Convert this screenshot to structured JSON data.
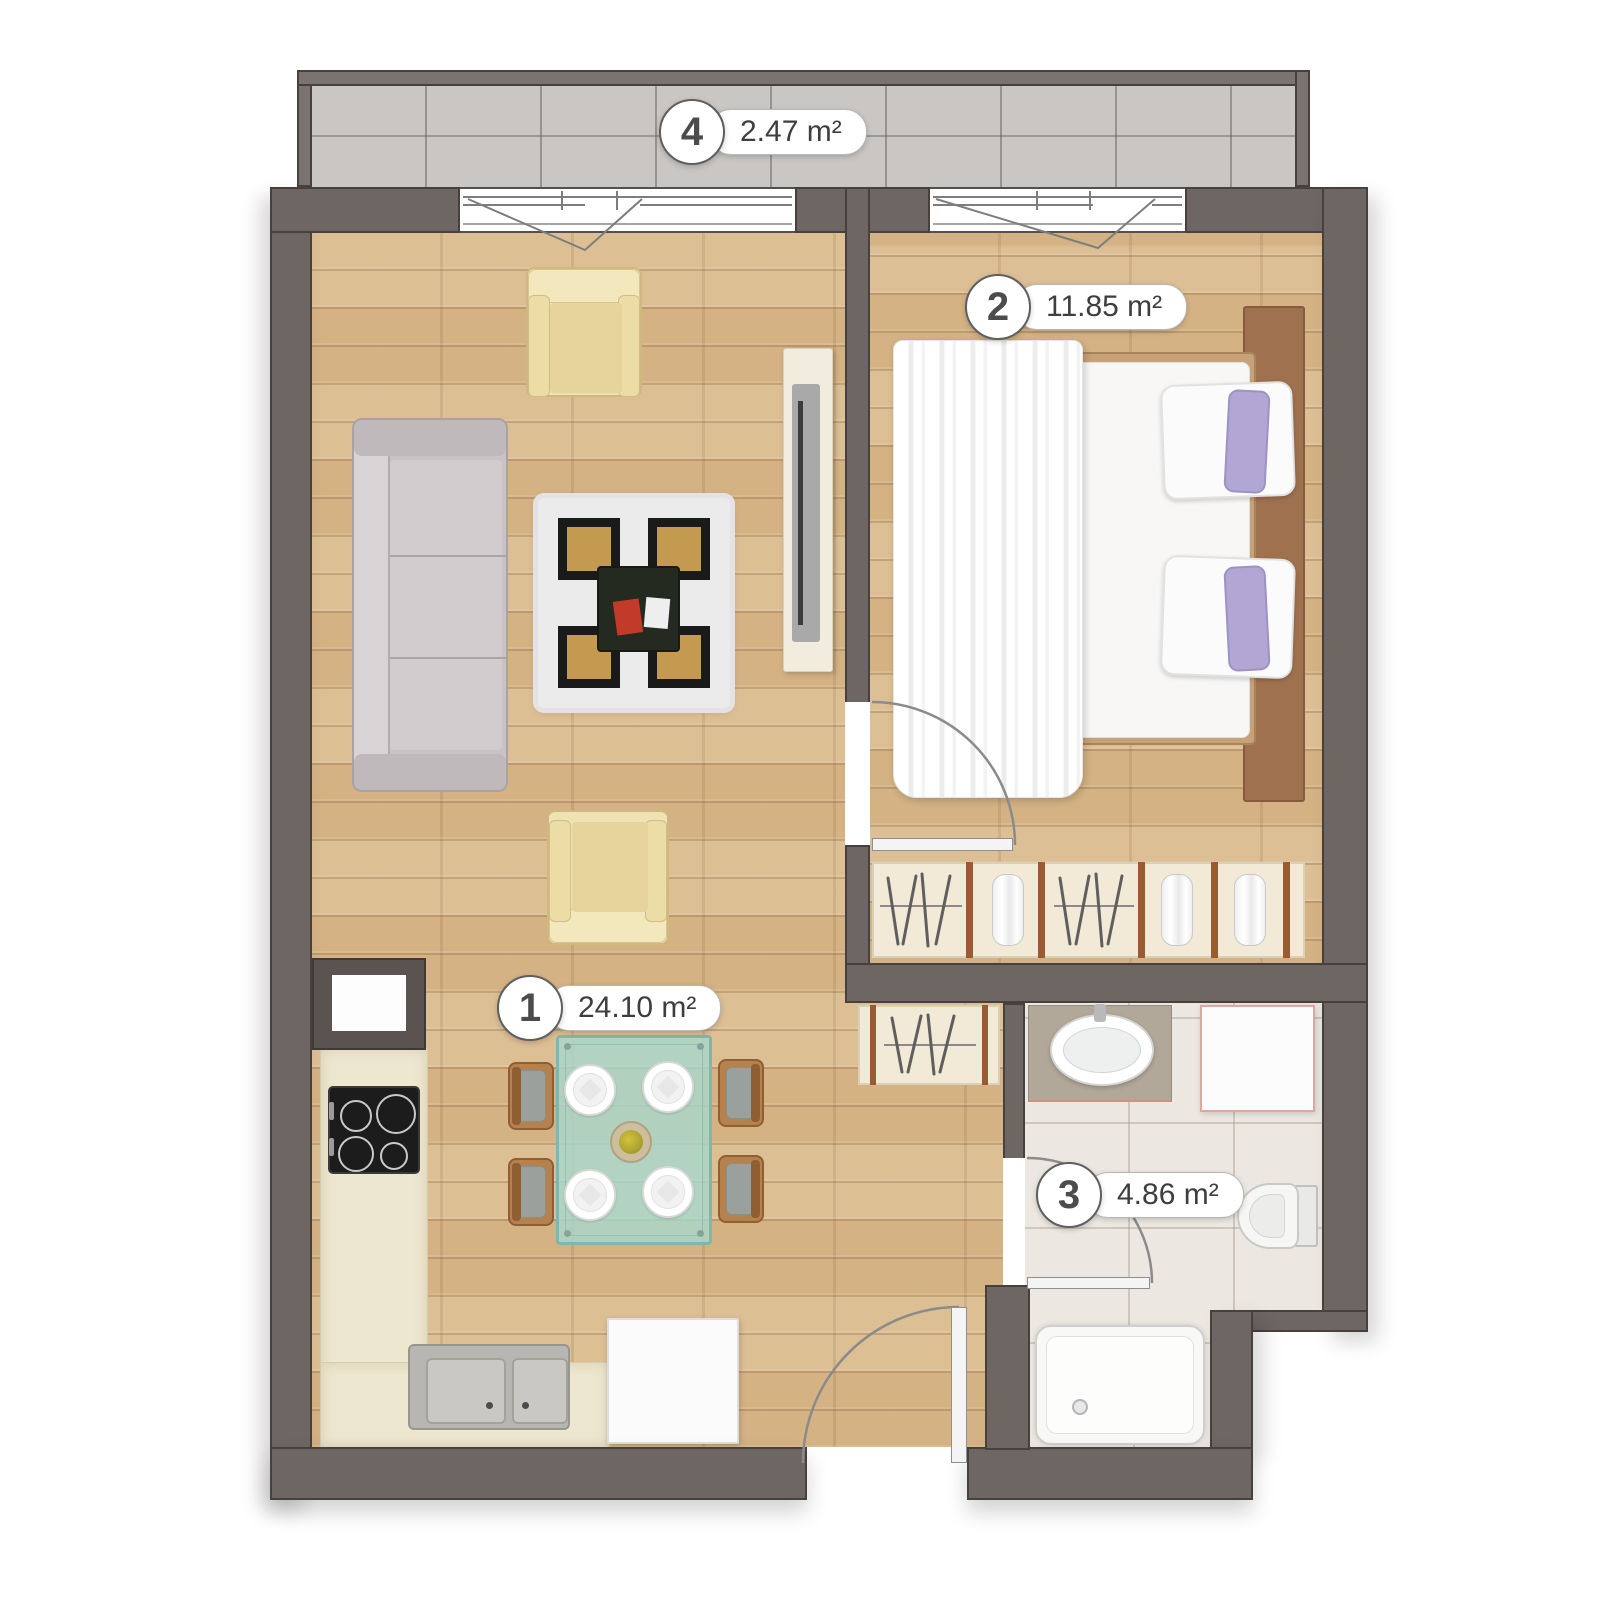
{
  "plan": {
    "rooms": [
      {
        "id": "living-kitchen",
        "number": "1",
        "area": "24.10 m²"
      },
      {
        "id": "bedroom",
        "number": "2",
        "area": "11.85 m²"
      },
      {
        "id": "bathroom",
        "number": "3",
        "area": "4.86 m²"
      },
      {
        "id": "balcony",
        "number": "4",
        "area": "2.47 m²"
      }
    ],
    "colors": {
      "wall": "#6e6663",
      "wall_outline": "#46403e",
      "wood_floor": "#d9b98d",
      "balcony_tile": "#c9c6c3",
      "bath_tile": "#ece8e1",
      "wardrobe_cream": "#f2ead6",
      "wardrobe_divider": "#9c5a32",
      "rug_gold": "#c49a50",
      "glass_teal": "#aed8cd",
      "pillow_lavender": "#b2a7d4",
      "armchair_cream": "#efe2b3",
      "label_text": "#3e3e3e"
    }
  }
}
